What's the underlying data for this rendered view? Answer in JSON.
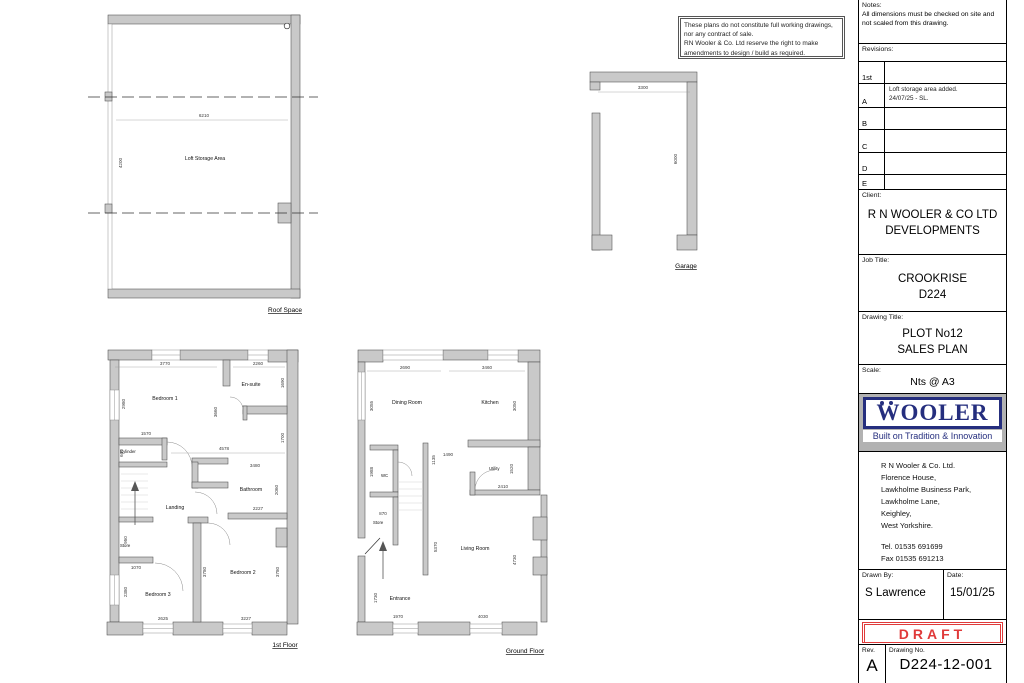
{
  "disclaimer": {
    "line1": "These plans do not constitute full working drawings,",
    "line2": "nor any contract of sale.",
    "line3": "RN Wooler & Co. Ltd reserve the right to make",
    "line4": "amendments to design / build as required."
  },
  "plans": {
    "roof": {
      "title": "Roof Space",
      "room": "Loft Storage Area",
      "dim_w": "6210",
      "dim_h": "4200"
    },
    "garage": {
      "title": "Garage",
      "dim_w": "3300",
      "dim_h": "6000"
    },
    "first": {
      "title": "1st Floor",
      "rooms": {
        "bed1": "Bedroom 1",
        "ensuite": "En-suite",
        "cylinder": "Cylinder",
        "bathroom": "Bathroom",
        "landing": "Landing",
        "store": "Store",
        "bed3": "Bedroom 3",
        "bed2": "Bedroom 2"
      },
      "dims": {
        "d3770": "3770",
        "d2260": "2260",
        "d2980": "2980",
        "d1690": "1690",
        "d3660": "3660",
        "d1570": "1570",
        "d600": "600",
        "d4578": "4578",
        "d1700": "1700",
        "d3480": "3480",
        "d2060": "2060",
        "d2227": "2227",
        "d950": "950",
        "d1070": "1070",
        "d2380": "2380",
        "d3780a": "3780",
        "d3780b": "3780",
        "d2625": "2625",
        "d3227": "3227"
      }
    },
    "ground": {
      "title": "Ground Floor",
      "rooms": {
        "dining": "Dining Room",
        "kitchen": "Kitchen",
        "wc": "WC",
        "utility": "Utility",
        "store": "Store",
        "living": "Living Room",
        "entrance": "Entrance"
      },
      "dims": {
        "d2690": "2690",
        "d3460": "3460",
        "d3055": "3055",
        "d3050": "3050",
        "d1988": "1988",
        "d1490": "1490",
        "d1135": "1135",
        "d1520": "1520",
        "d2410": "2410",
        "d870": "870",
        "d5370": "5370",
        "d4730": "4730",
        "d1730": "1730",
        "d1970": "1970",
        "d4030": "4030"
      }
    }
  },
  "titleblock": {
    "notes_label": "Notes:",
    "notes_text": "All dimensions must be checked on site and not scaled from this drawing.",
    "revisions_label": "Revisions:",
    "revisions": [
      {
        "rev": "1st",
        "desc1": "",
        "desc2": ""
      },
      {
        "rev": "A",
        "desc1": "Loft storage area added.",
        "desc2": "24/07/25 - SL."
      },
      {
        "rev": "B",
        "desc1": "",
        "desc2": ""
      },
      {
        "rev": "C",
        "desc1": "",
        "desc2": ""
      },
      {
        "rev": "D",
        "desc1": "",
        "desc2": ""
      },
      {
        "rev": "E",
        "desc1": "",
        "desc2": ""
      }
    ],
    "client_label": "Client:",
    "client_line1": "R N WOOLER & CO LTD",
    "client_line2": "DEVELOPMENTS",
    "job_label": "Job Title:",
    "job_line1": "CROOKRISE",
    "job_line2": "D224",
    "drawing_label": "Drawing Title:",
    "drawing_line1": "PLOT No12",
    "drawing_line2": "SALES PLAN",
    "scale_label": "Scale:",
    "scale_value": "Nts @ A3",
    "logo_text": "WOOLER",
    "logo_tagline": "Built on Tradition & Innovation",
    "address": [
      "R N Wooler & Co. Ltd.",
      "Florence House,",
      "Lawkholme Business Park,",
      "Lawkholme Lane,",
      "Keighley,",
      "West Yorkshire."
    ],
    "tel": "Tel. 01535 691699",
    "fax": "Fax 01535 691213",
    "drawnby_label": "Drawn By:",
    "drawnby_value": "S Lawrence",
    "date_label": "Date:",
    "date_value": "15/01/25",
    "draft": "DRAFT",
    "rev_label": "Rev.",
    "rev_value": "A",
    "dwgno_label": "Drawing No.",
    "dwgno_value": "D224-12-001"
  },
  "colors": {
    "accent_navy": "#252e7e",
    "draft_red": "#e03a3a",
    "wall_gray": "#c9c9c9"
  }
}
